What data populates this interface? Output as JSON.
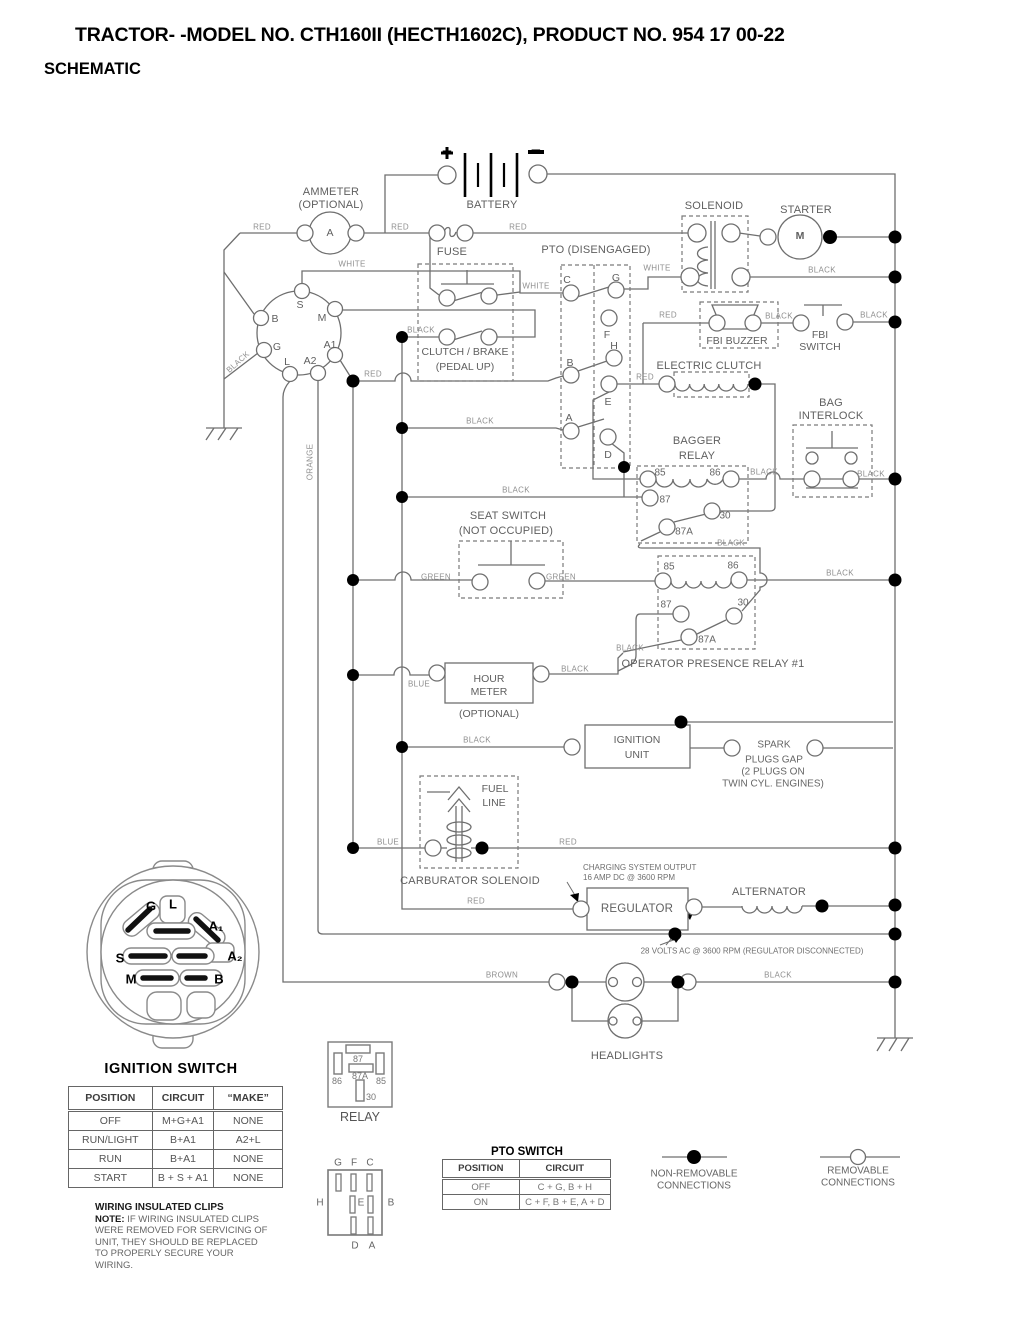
{
  "title": {
    "line1": "TRACTOR- -MODEL NO. CTH160II (HECTH1602C), PRODUCT NO. 954 17 00-22",
    "line2": "SCHEMATIC"
  },
  "wire": {
    "red": "RED",
    "black": "BLACK",
    "white": "WHITE",
    "green": "GREEN",
    "blue": "BLUE",
    "brown": "BROWN",
    "orange": "ORANGE"
  },
  "components": {
    "ammeter_1": "AMMETER",
    "ammeter_2": "(OPTIONAL)",
    "ammeter_a": "A",
    "battery": "BATTERY",
    "plus": "+",
    "minus": "−",
    "fuse": "FUSE",
    "pto": "PTO (DISENGAGED)",
    "solenoid": "SOLENOID",
    "starter": "STARTER",
    "starter_m": "M",
    "clutch_1": "CLUTCH / BRAKE",
    "clutch_2": "(PEDAL UP)",
    "fbi_buzzer": "FBI BUZZER",
    "fbi_1": "FBI",
    "fbi_2": "SWITCH",
    "electric_clutch": "ELECTRIC CLUTCH",
    "bagger_1": "BAGGER",
    "bagger_2": "RELAY",
    "bag_1": "BAG",
    "bag_2": "INTERLOCK",
    "seat_1": "SEAT SWITCH",
    "seat_2": "(NOT OCCUPIED)",
    "op_relay": "OPERATOR PRESENCE RELAY #1",
    "hour_1": "HOUR",
    "hour_2": "METER",
    "hour_opt": "(OPTIONAL)",
    "ign_1": "IGNITION",
    "ign_2": "UNIT",
    "spark_1": "SPARK",
    "spark_2": "PLUGS GAP",
    "spark_3": "(2 PLUGS ON",
    "spark_4": "TWIN CYL. ENGINES)",
    "fuel_1": "FUEL",
    "fuel_2": "LINE",
    "carb": "CARBURATOR SOLENOID",
    "regulator": "REGULATOR",
    "alternator": "ALTERNATOR",
    "headlights": "HEADLIGHTS",
    "relay": "RELAY"
  },
  "annotations": {
    "charging_1": "CHARGING SYSTEM OUTPUT",
    "charging_2": "16 AMP DC @ 3600 RPM",
    "volts": "28 VOLTS AC @ 3600 RPM (REGULATOR DISCONNECTED)"
  },
  "pto_pins": {
    "a": "A",
    "b": "B",
    "c": "C",
    "d": "D",
    "e": "E",
    "f": "F",
    "g": "G",
    "h": "H"
  },
  "ign_pins": {
    "s": "S",
    "m": "M",
    "b": "B",
    "g": "G",
    "l": "L",
    "a1": "A1",
    "a2": "A2"
  },
  "relay_pins": {
    "p30": "30",
    "p85": "85",
    "p86": "86",
    "p87": "87",
    "p87a": "87A"
  },
  "connector": {
    "title": "IGNITION SWITCH",
    "g": "G",
    "l": "L",
    "a1": "A₁",
    "a2": "A₂",
    "s": "S",
    "m": "M",
    "b": "B"
  },
  "ignition_table": {
    "headers": [
      "POSITION",
      "CIRCUIT",
      "“MAKE”"
    ],
    "rows": [
      [
        "OFF",
        "M+G+A1",
        "NONE"
      ],
      [
        "RUN/LIGHT",
        "B+A1",
        "A2+L"
      ],
      [
        "RUN",
        "B+A1",
        "NONE"
      ],
      [
        "START",
        "B + S + A1",
        "NONE"
      ]
    ]
  },
  "pto_table": {
    "title": "PTO SWITCH",
    "headers": [
      "POSITION",
      "CIRCUIT"
    ],
    "rows": [
      [
        "OFF",
        "C + G, B + H"
      ],
      [
        "ON",
        "C + F, B + E, A + D"
      ]
    ]
  },
  "note": {
    "title": "WIRING INSULATED CLIPS",
    "label": "NOTE:",
    "text": "IF WIRING INSULATED CLIPS WERE REMOVED FOR SERVICING OF UNIT, THEY SHOULD BE REPLACED TO PROPERLY SECURE YOUR WIRING."
  },
  "legend": {
    "non_removable_1": "NON-REMOVABLE",
    "non_removable_2": "CONNECTIONS",
    "removable_1": "REMOVABLE",
    "removable_2": "CONNECTIONS"
  }
}
